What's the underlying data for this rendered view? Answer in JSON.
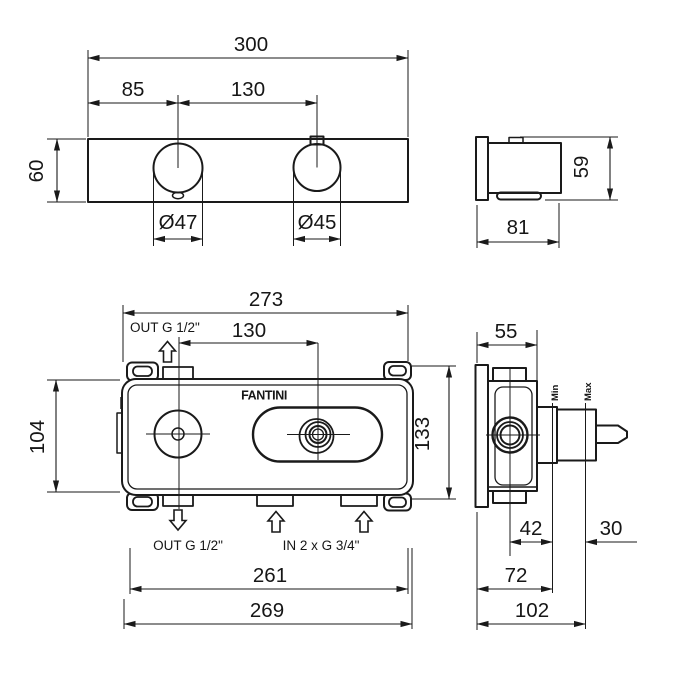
{
  "front_view": {
    "width": "300",
    "offset": "85",
    "centers": "130",
    "height": "60",
    "dia_left": "Ø47",
    "dia_right": "Ø45"
  },
  "side_view": {
    "height": "59",
    "depth": "81"
  },
  "rough_front_view": {
    "width": "273",
    "centers": "130",
    "inner_height": "104",
    "height": "133",
    "mount_width": "261",
    "outer_width": "269",
    "out_top_label": "OUT G 1/2\"",
    "out_bottom_label": "OUT G 1/2\"",
    "in_label": "IN 2 x G 3/4\"",
    "brand": "FANTINI"
  },
  "rough_side_view": {
    "depth": "55",
    "min_depth": "42",
    "adjust_range": "30",
    "depth_mid": "72",
    "depth_total": "102",
    "min_label": "Min",
    "max_label": "Max"
  },
  "colors": {
    "line": "#1a1a1a",
    "background": "#ffffff"
  }
}
